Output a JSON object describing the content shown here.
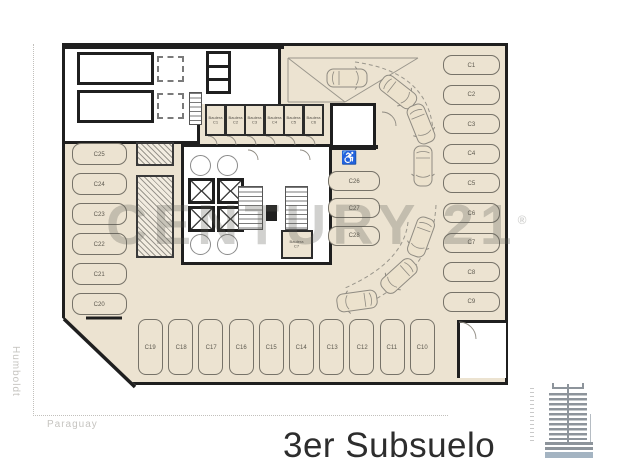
{
  "page": {
    "title": "3er Subsuelo",
    "watermark": "CENTURY 21",
    "watermark_mark": "®"
  },
  "streets": {
    "left_vertical": "Humboldt",
    "bottom_horizontal": "Paraguay"
  },
  "parking_spots": {
    "right_column": [
      "C1",
      "C2",
      "C3",
      "C4",
      "C5",
      "C6",
      "C7",
      "C8",
      "C9"
    ],
    "left_column": [
      "C25",
      "C24",
      "C23",
      "C22",
      "C21",
      "C20"
    ],
    "center_column": [
      "C26",
      "C27",
      "C28"
    ],
    "bottom_row": [
      "C19",
      "C18",
      "C17",
      "C16",
      "C15",
      "C14",
      "C13",
      "C12",
      "C11",
      "C10"
    ]
  },
  "storage_rooms": {
    "top_row": [
      "Baulera C1",
      "Baulera C2",
      "Baulera C3",
      "Baulera C4",
      "Baulera C5",
      "Baulera C6"
    ],
    "core_room": "Baulera C7"
  },
  "icons": {
    "accessible_parking": "♿"
  },
  "colors": {
    "floor": "#ece3d1",
    "wall": "#1f1f1f",
    "watermark": "rgba(90,88,82,0.28)",
    "base_highlight": "#a4b4c2"
  }
}
